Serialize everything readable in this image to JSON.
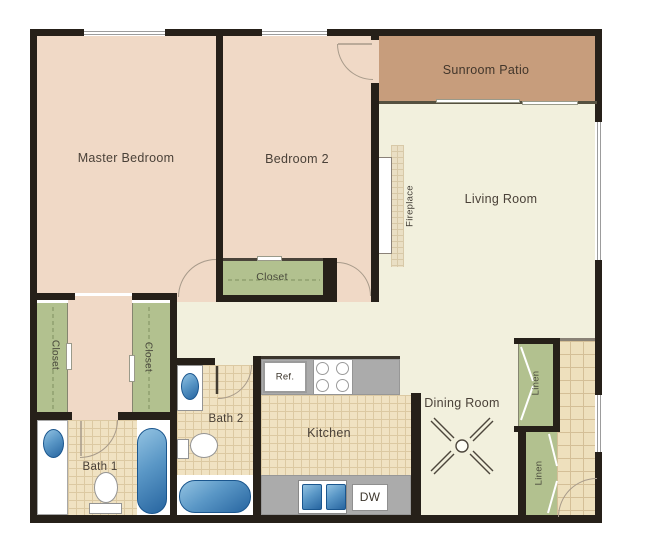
{
  "labels": {
    "master_bedroom": "Master Bedroom",
    "bedroom_2": "Bedroom 2",
    "sunroom_patio": "Sunroom Patio",
    "living_room": "Living Room",
    "dining_room": "Dining Room",
    "kitchen": "Kitchen",
    "bath_1": "Bath 1",
    "bath_2": "Bath 2",
    "closet_left": "Closet",
    "closet_right": "Closet",
    "closet_bedroom2": "Closet",
    "linen_upper": "Linen",
    "linen_lower": "Linen",
    "fireplace": "Fireplace",
    "refrigerator": "Ref.",
    "dishwasher": "DW"
  },
  "colors": {
    "wall": "#262019",
    "bedroom_floor": "#f0d9c6",
    "living_floor": "#f2f0dd",
    "patio_floor": "#c79d7c",
    "closet_floor": "#b2c18f",
    "tile_floor": "#f0e2c2",
    "counter": "#ababab",
    "fixture_blue": "#3572ab",
    "fixture_white": "#ffffff"
  },
  "fixtures": {
    "bath_1": [
      "sink",
      "toilet",
      "bathtub"
    ],
    "bath_2": [
      "sink",
      "toilet",
      "bathtub"
    ],
    "kitchen": [
      "refrigerator",
      "stove",
      "double-sink",
      "dishwasher"
    ],
    "living_room": [
      "fireplace"
    ],
    "dining_room": [
      "ceiling-fan"
    ],
    "doors": [
      "swing-door",
      "sliding-closet-door",
      "bifold-door",
      "sliding-glass-door"
    ]
  }
}
